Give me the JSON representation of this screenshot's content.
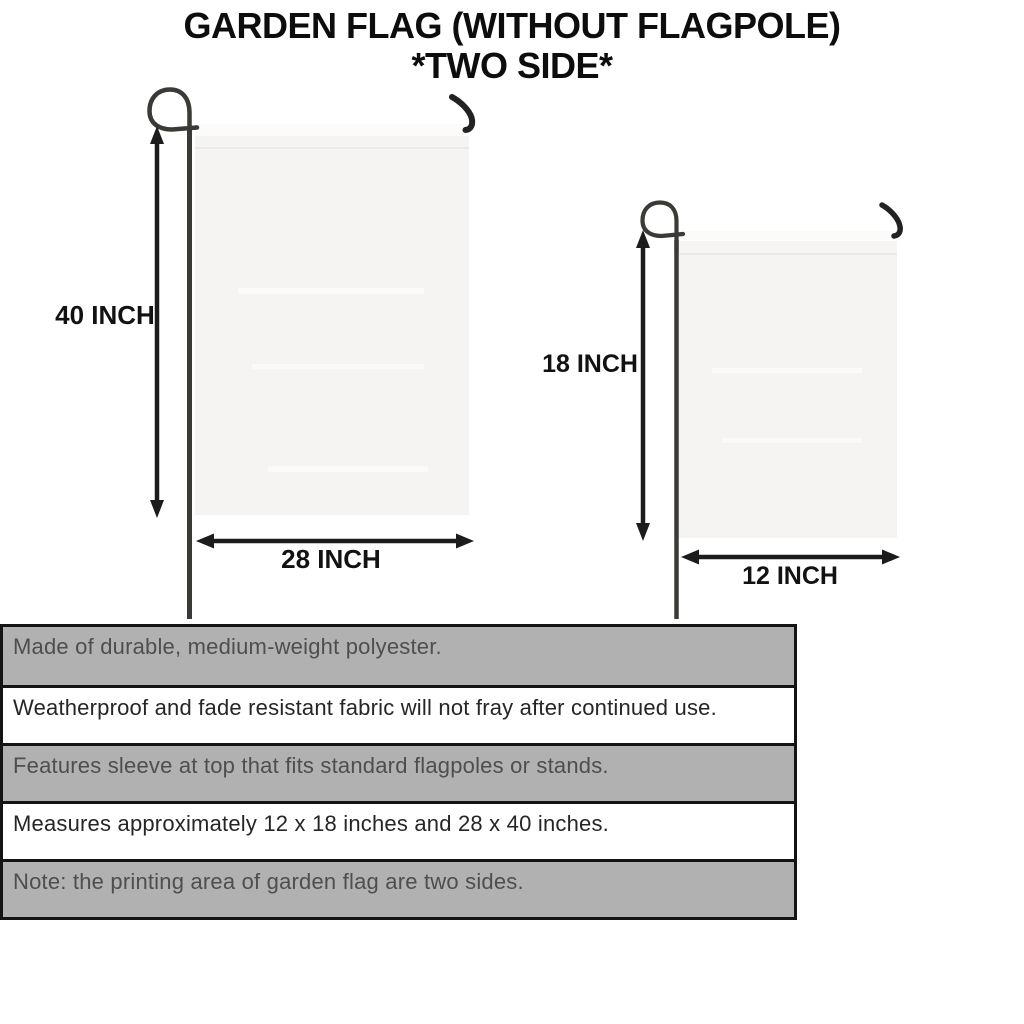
{
  "title": {
    "line1": "GARDEN FLAG (WITHOUT FLAGPOLE)",
    "line2": "*TWO SIDE*"
  },
  "diagram": {
    "large_flag": {
      "name": "garden flag 28 x 40 inches",
      "height_label": "40 INCH",
      "width_label": "28 INCH"
    },
    "small_flag": {
      "name": "garden flag 12 x 18 inches",
      "height_label": "18 INCH",
      "width_label": "12 INCH"
    }
  },
  "specs": {
    "rows": [
      {
        "text": "Made of durable, medium-weight polyester.",
        "shaded": true
      },
      {
        "text": "Weatherproof and fade resistant fabric will not fray after continued use.",
        "shaded": false
      },
      {
        "text": "Features sleeve at top that fits standard flagpoles or stands.",
        "shaded": true
      },
      {
        "text": "Measures approximately 12 x 18 inches and 28 x 40 inches.",
        "shaded": false
      },
      {
        "text": "Note: the printing area of garden flag are two sides.",
        "shaded": true
      }
    ]
  },
  "colors": {
    "shaded_row_bg": "#b1b1b1",
    "row_border": "#141414",
    "fabric": "#f5f4f2",
    "pole": "#3a3a37",
    "arrow": "#1c1c1c"
  }
}
